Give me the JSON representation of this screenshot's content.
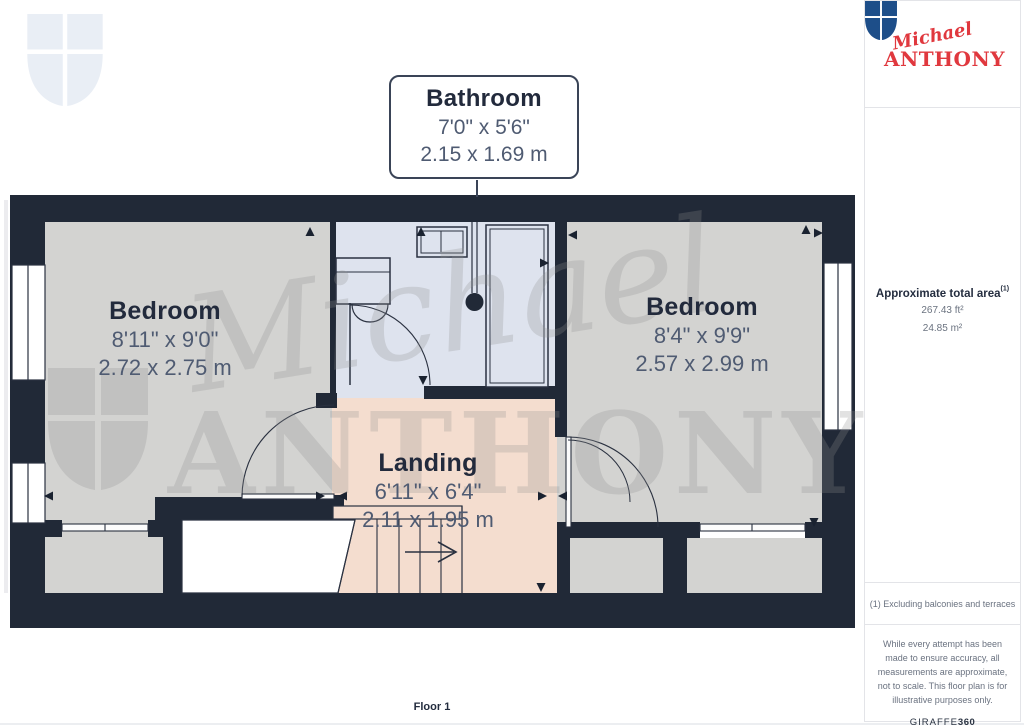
{
  "page": {
    "floor_label": "Floor 1"
  },
  "branding": {
    "logo_script": "Michael",
    "logo_caps": "ANTHONY",
    "watermark_script": "Michael",
    "watermark_caps": "ANTHONY"
  },
  "rooms": {
    "bathroom": {
      "name": "Bathroom",
      "imperial": "7'0\" x 5'6\"",
      "metric": "2.15 x 1.69 m"
    },
    "bedroom_left": {
      "name": "Bedroom",
      "imperial": "8'11\" x 9'0\"",
      "metric": "2.72 x 2.75 m"
    },
    "bedroom_right": {
      "name": "Bedroom",
      "imperial": "8'4\" x 9'9\"",
      "metric": "2.57 x 2.99 m"
    },
    "landing": {
      "name": "Landing",
      "imperial": "6'11\" x 6'4\"",
      "metric": "2.11 x 1.95 m"
    }
  },
  "sidebar": {
    "area_title": "Approximate total area",
    "area_note_ref": "(1)",
    "area_ft": "267.43 ft²",
    "area_m": "24.85 m²",
    "footnote": "(1) Excluding balconies and terraces",
    "disclaimer": "While every attempt has been made to ensure accuracy, all measurements are approximate, not to scale. This floor plan is for illustrative purposes only.",
    "provider": "GIRAFFE",
    "provider_bold": "360"
  },
  "colors": {
    "wall": "#212937",
    "floor_gray": "#d3d3d1",
    "floor_bath": "#dee3ee",
    "floor_landing": "#f4ddcf",
    "accent_red": "#e0383e",
    "shield_blue": "#1d4e89"
  }
}
